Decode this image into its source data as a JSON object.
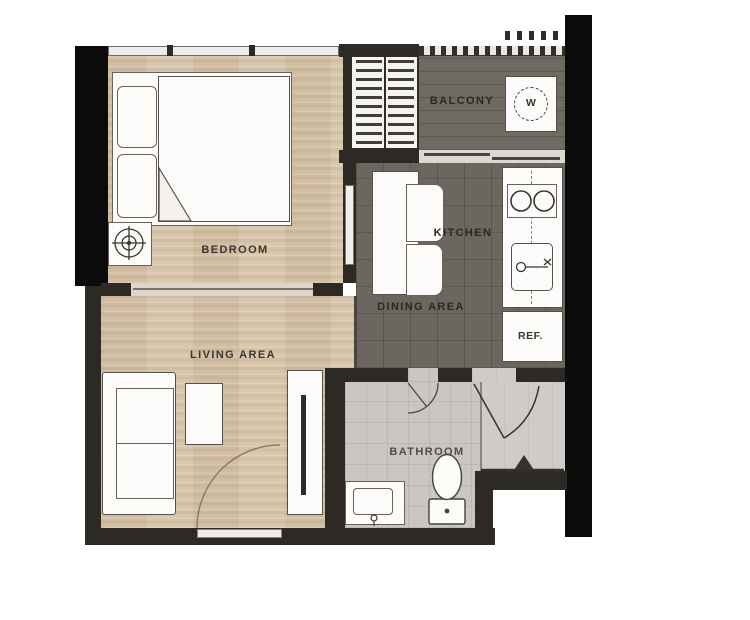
{
  "title": "One-bedroom apartment floor plan",
  "plan": {
    "rooms": {
      "bedroom": {
        "label": "BEDROOM"
      },
      "living_area": {
        "label": "LIVING AREA"
      },
      "kitchen": {
        "label": "KITCHEN"
      },
      "dining_area": {
        "label": "DINING AREA"
      },
      "balcony": {
        "label": "BALCONY"
      },
      "bathroom": {
        "label": "BATHROOM"
      }
    },
    "appliances": {
      "refrigerator": {
        "label": "REF."
      },
      "washing_machine": {
        "label": "W"
      }
    },
    "icons": [
      "ceiling-fan-icon",
      "washing-machine-icon",
      "stove-burners-icon",
      "kitchen-sink-icon",
      "toilet-icon",
      "bathroom-sink-icon",
      "door-swing-arc",
      "entrance-arrow-icon"
    ],
    "colors": {
      "background": "#ffffff",
      "wall_black": "#0b0b0b",
      "wall_dark": "#2d2a25",
      "wood_floor": "#d9c7ac",
      "tile_dark_floor": "#6b675e",
      "balcony_floor": "#6f6b63",
      "bathroom_floor": "#cac7c2",
      "hall_floor": "#cfccc7",
      "label_text": "#3a362f"
    }
  }
}
